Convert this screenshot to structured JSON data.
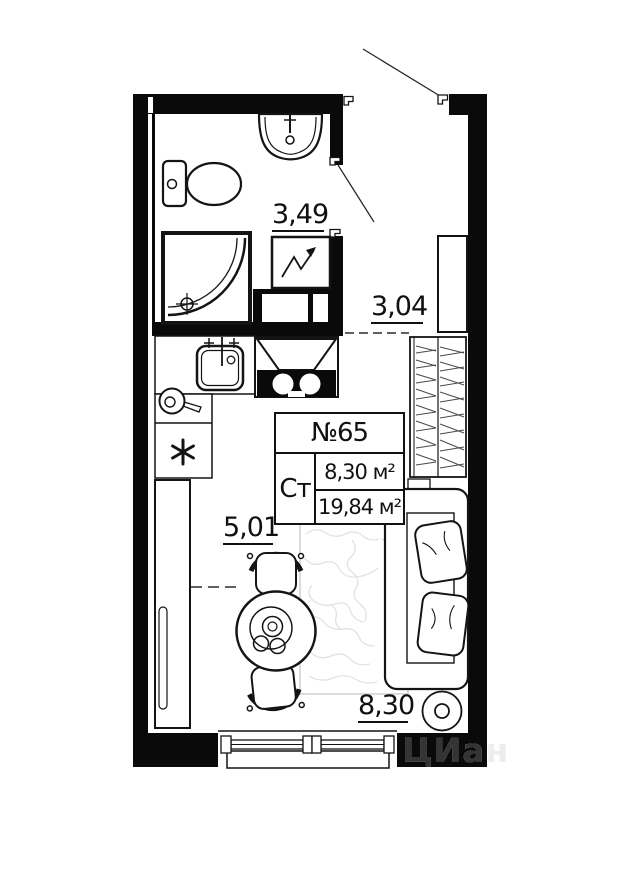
{
  "unit_box": {
    "number": "№65",
    "type": "Ст",
    "room_area": "8,30 м²",
    "total_area": "19,84 м²"
  },
  "dimensions": {
    "bathroom_width": "3,49",
    "entry_width": "3,04",
    "room_width": "5,01",
    "room_length": "8,30"
  },
  "watermark": "ЦИан",
  "colors": {
    "wall": "#0a0a0a",
    "line": "#141414",
    "dim_text": "#101010",
    "hatch": "#4a4a4a",
    "carpet_line": "#e2e2e2",
    "watermark_on_wall": "#343434",
    "watermark_on_bg": "#ededed",
    "background": "#ffffff"
  }
}
